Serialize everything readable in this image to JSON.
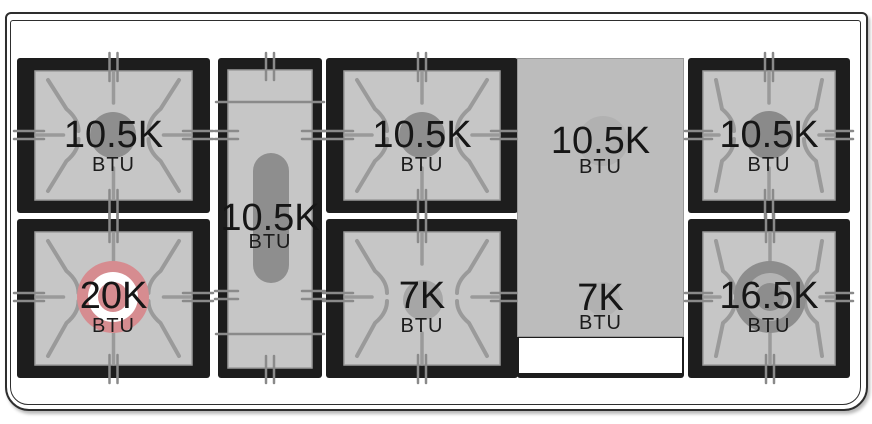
{
  "diagram_title": "range-top-burner-layout",
  "burners": {
    "top_left": {
      "value": "10.5K",
      "unit": "BTU"
    },
    "bottom_left": {
      "value": "20K",
      "unit": "BTU"
    },
    "center_oval": {
      "value": "10.5K",
      "unit": "BTU"
    },
    "top_middle": {
      "value": "10.5K",
      "unit": "BTU"
    },
    "bottom_middle": {
      "value": "7K",
      "unit": "BTU"
    },
    "griddle_top": {
      "value": "10.5K",
      "unit": "BTU"
    },
    "griddle_bottom": {
      "value": "7K",
      "unit": "BTU"
    },
    "top_right": {
      "value": "10.5K",
      "unit": "BTU"
    },
    "bottom_right": {
      "value": "16.5K",
      "unit": "BTU"
    }
  },
  "colors": {
    "highlight_pink": "#d68c90",
    "box_black": "#1d1d1d",
    "burner_surface": "#c6c6c6",
    "griddle_gray": "#bcbcbc",
    "burner_gray": "#8e8e8e"
  }
}
